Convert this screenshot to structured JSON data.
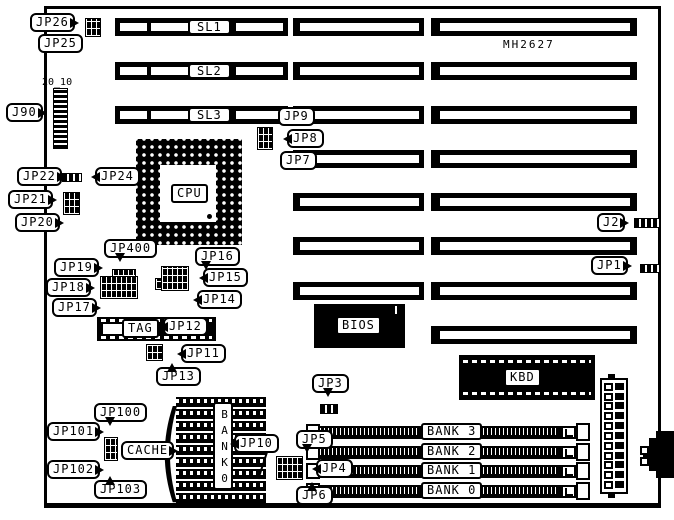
{
  "colors": {
    "ink": "#000000",
    "paper": "#ffffff"
  },
  "board": {
    "model": "MH2627",
    "j90_pin_numbers": "20_10"
  },
  "slots": {
    "sl1": "SL1",
    "sl2": "SL2",
    "sl3": "SL3"
  },
  "chips": {
    "cpu": "CPU",
    "bios": "BIOS",
    "kbd": "KBD",
    "tag": "TAG",
    "cache": "CACHE",
    "cache_bank_vertical": "BANK0"
  },
  "memory": {
    "banks": [
      "BANK 3",
      "BANK 2",
      "BANK 1",
      "BANK 0"
    ]
  },
  "jumpers": {
    "jp26": "JP26",
    "jp25": "JP25",
    "j90": "J90",
    "jp9": "JP9",
    "jp8": "JP8",
    "jp7": "JP7",
    "jp22": "JP22",
    "jp24": "JP24",
    "jp21": "JP21",
    "jp20": "JP20",
    "j2": "J2",
    "jp1": "JP1",
    "jp400": "JP400",
    "jp19": "JP19",
    "jp18": "JP18",
    "jp17": "JP17",
    "jp16": "JP16",
    "jp15": "JP15",
    "jp14": "JP14",
    "jp12": "JP12",
    "jp11": "JP11",
    "jp13": "JP13",
    "jp3": "JP3",
    "jp100": "JP100",
    "jp101": "JP101",
    "jp102": "JP102",
    "jp103": "JP103",
    "jp10": "JP10",
    "jp5": "JP5",
    "jp4": "JP4",
    "jp6": "JP6"
  }
}
